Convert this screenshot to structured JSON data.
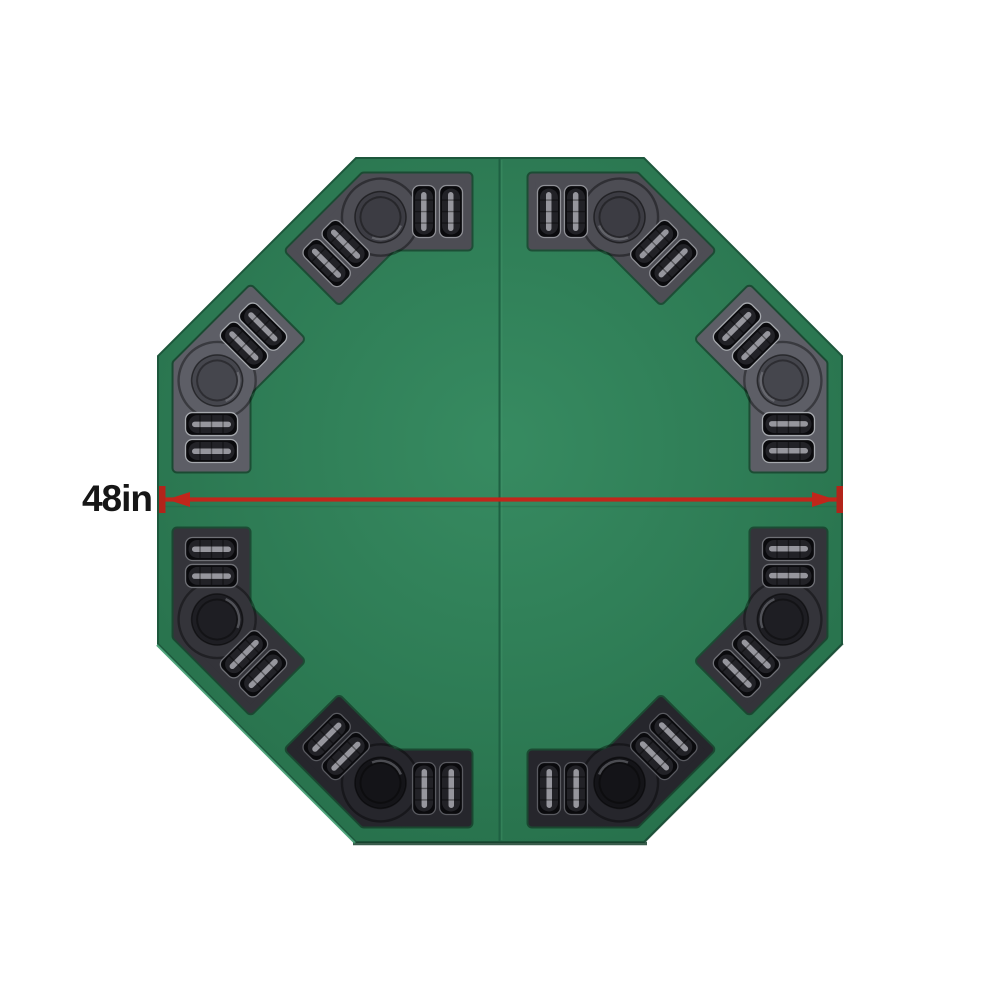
{
  "page": {
    "background_color": "#ffffff"
  },
  "dimension": {
    "label": "48in",
    "value_inches": 48,
    "color": "#c1261b",
    "tick_color": "#b2241a",
    "text_color": "#161616"
  },
  "table": {
    "shape": "octagon",
    "felt_light": "#378b61",
    "felt_mid": "#2e7c55",
    "felt_dark": "#266f4a",
    "border_color": "#1d573c",
    "seam_color": "#1e6042",
    "seat_count": 8,
    "chip_slots_per_seat": 4,
    "cup_holders_per_seat": 1,
    "trays": [
      {
        "position": "top-left"
      },
      {
        "position": "top-right"
      },
      {
        "position": "right-top"
      },
      {
        "position": "right-bottom"
      },
      {
        "position": "bottom-right"
      },
      {
        "position": "bottom-left"
      },
      {
        "position": "left-bottom"
      },
      {
        "position": "left-top"
      }
    ]
  }
}
